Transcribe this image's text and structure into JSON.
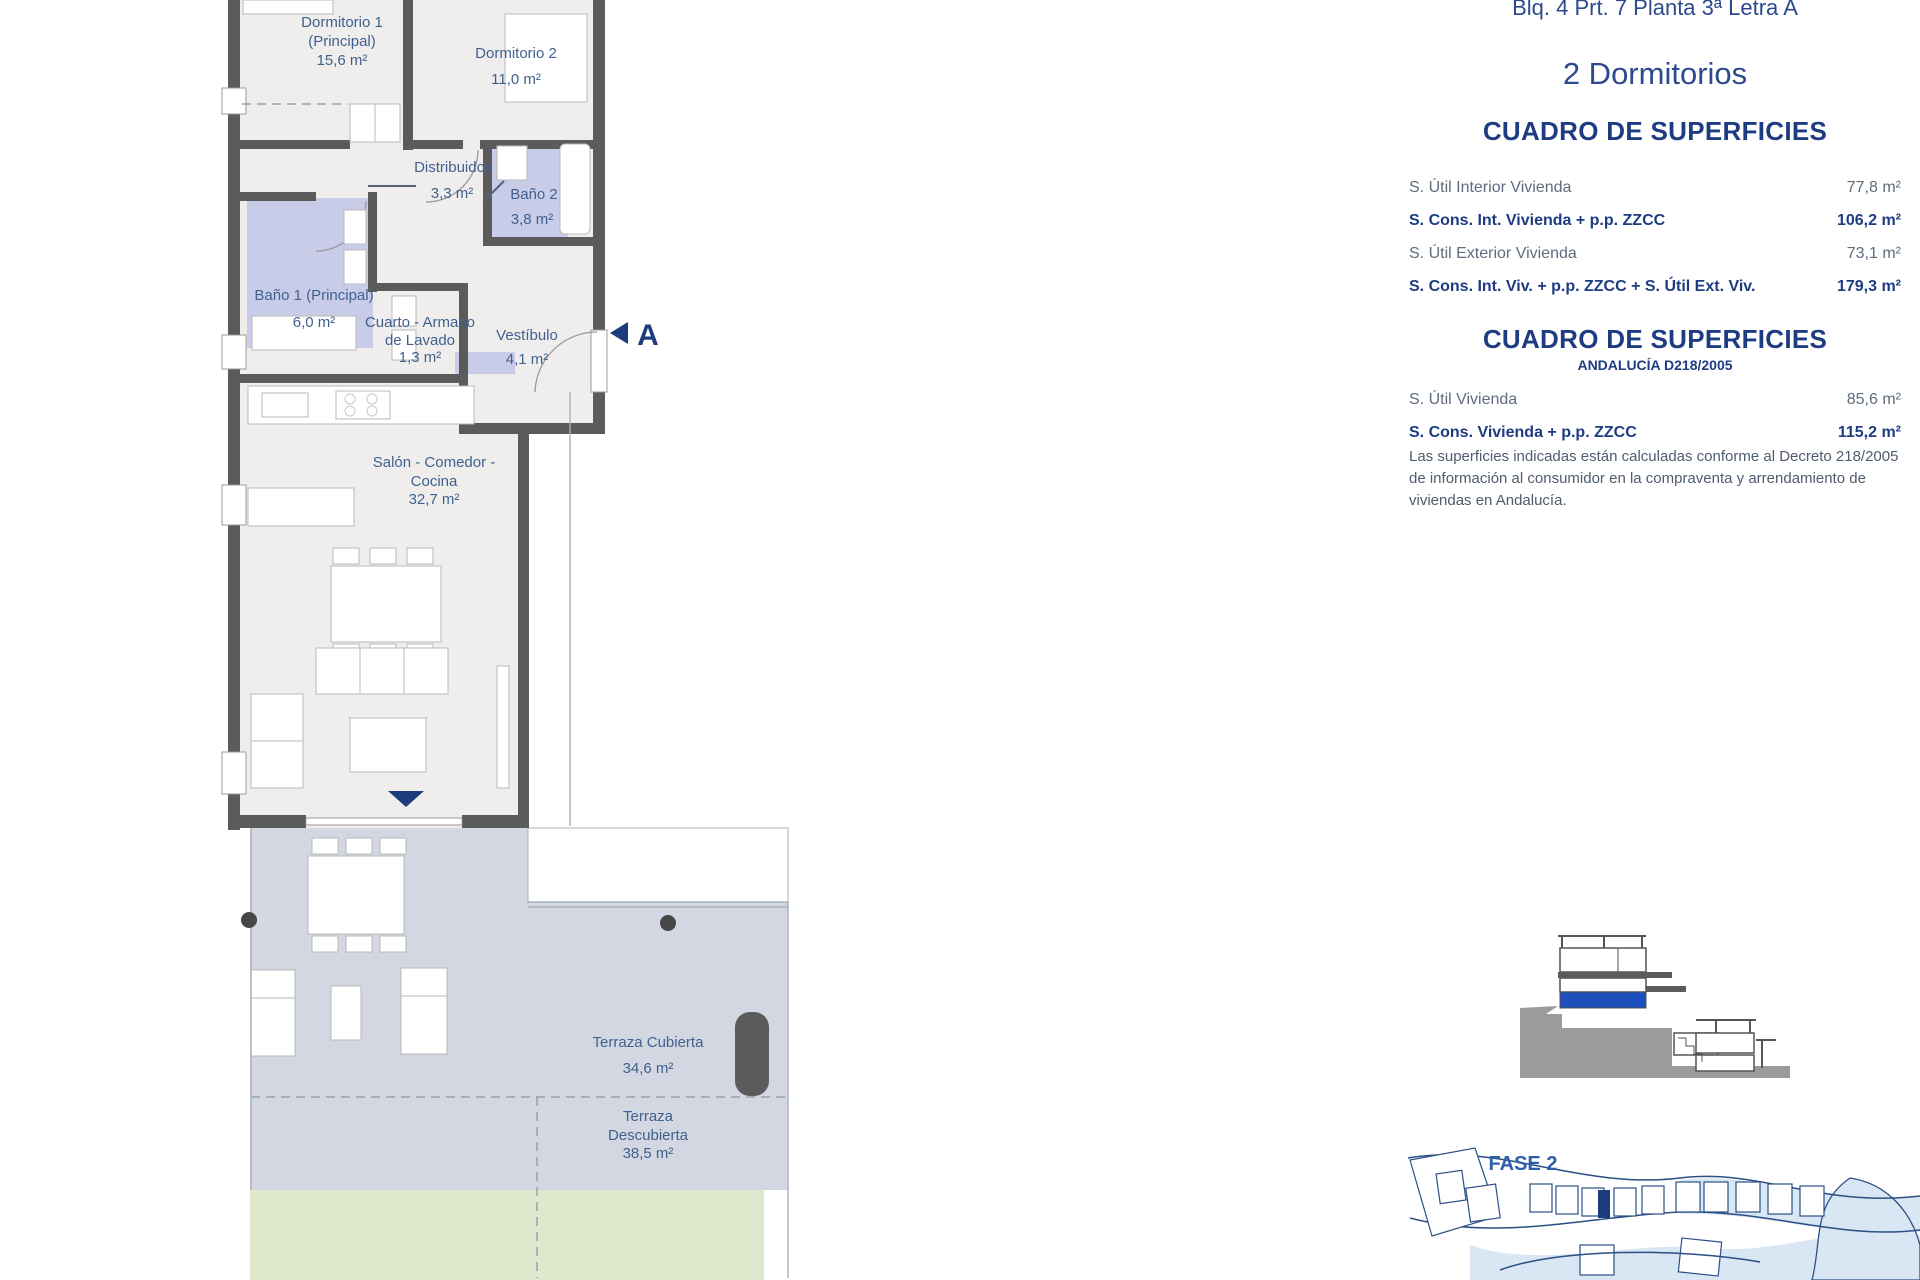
{
  "header": {
    "unit_reference": "Blq. 4 Prt. 7 Planta 3ª Letra A",
    "bedrooms_title": "2 Dormitorios"
  },
  "surface_tables": [
    {
      "title": "CUADRO DE SUPERFICIES",
      "rows": [
        {
          "label": "S. Útil Interior Vivienda",
          "value": "77,8 m²",
          "emphasis": false
        },
        {
          "label": "S. Cons. Int. Vivienda + p.p. ZZCC",
          "value": "106,2 m²",
          "emphasis": true
        },
        {
          "label": "S. Útil Exterior Vivienda",
          "value": "73,1 m²",
          "emphasis": false
        },
        {
          "label": "S. Cons. Int. Viv. + p.p. ZZCC + S. Útil Ext. Viv.",
          "value": "179,3 m²",
          "emphasis": true
        }
      ]
    },
    {
      "title": "CUADRO DE SUPERFICIES",
      "subtitle": "ANDALUCÍA D218/2005",
      "rows": [
        {
          "label": "S. Útil Vivienda",
          "value": "85,6 m²",
          "emphasis": false
        },
        {
          "label": "S. Cons. Vivienda + p.p. ZZCC",
          "value": "115,2 m²",
          "emphasis": true
        }
      ],
      "note": "Las superficies indicadas están calculadas conforme al Decreto 218/2005 de información al consumidor en la compraventa y arrendamiento de viviendas en Andalucía."
    }
  ],
  "floorplan": {
    "rooms": {
      "dormitorio1": {
        "line1": "Dormitorio 1",
        "line2": "(Principal)",
        "area": "15,6 m²"
      },
      "dormitorio2": {
        "name": "Dormitorio 2",
        "area": "11,0 m²"
      },
      "distribuidor": {
        "name": "Distribuidor",
        "area": "3,3 m²"
      },
      "bano2": {
        "name": "Baño 2",
        "area": "3,8 m²"
      },
      "bano1": {
        "name": "Baño 1 (Principal)",
        "area": "6,0 m²"
      },
      "cuarto_lavado": {
        "line1": "Cuarto - Armario",
        "line2": "de Lavado",
        "area": "1,3 m²"
      },
      "vestibulo": {
        "name": "Vestíbulo",
        "area": "4,1 m²"
      },
      "salon": {
        "line1": "Salón - Comedor -",
        "line2": "Cocina",
        "area": "32,7 m²"
      },
      "terraza_cubierta": {
        "name": "Terraza Cubierta",
        "area": "34,6 m²"
      },
      "terraza_descubierta": {
        "line1": "Terraza",
        "line2": "Descubierta",
        "area": "38,5 m²"
      }
    },
    "section_marker": "A"
  },
  "site_plan": {
    "phase_label": "FASE 2"
  },
  "colors": {
    "accent_navy": "#1d3c7c",
    "heading_navy": "#1e3c82",
    "bathroom_fill": "#c9cce8",
    "terrace_fill": "#d3d7e2",
    "garden_fill": "#dfe8cd",
    "wall_gray": "#5b5b5b",
    "section_highlight_blue": "#1b50bc"
  }
}
